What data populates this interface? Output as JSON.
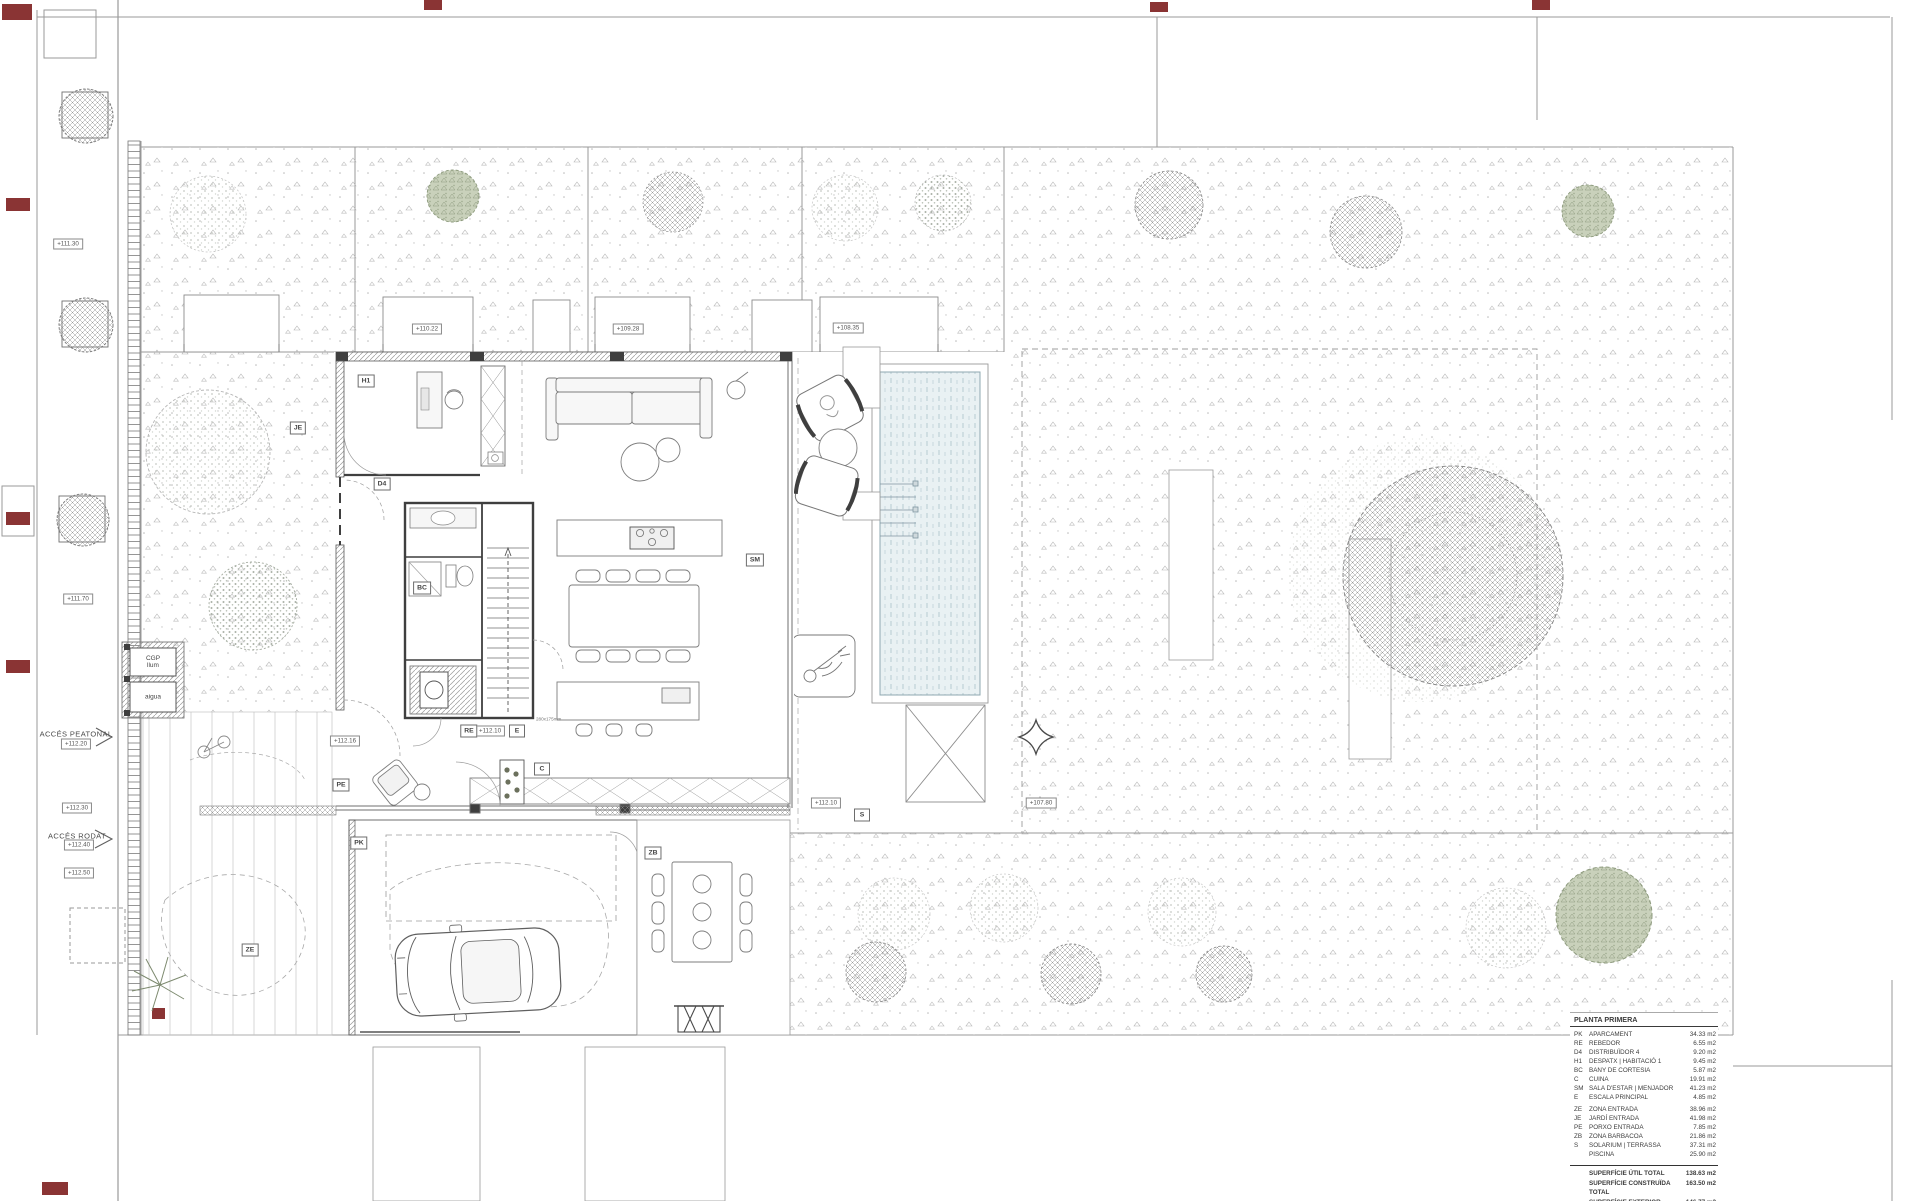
{
  "legend": {
    "header": "PLANTA PRIMERA",
    "groups": [
      {
        "rows": [
          {
            "code": "PK",
            "name": "APARCAMENT",
            "area": "34.33 m2"
          },
          {
            "code": "RE",
            "name": "REBEDOR",
            "area": "6.55 m2"
          },
          {
            "code": "D4",
            "name": "DISTRIBUÏDOR 4",
            "area": "9.20 m2"
          },
          {
            "code": "H1",
            "name": "DESPATX | HABITACIÓ 1",
            "area": "9.45 m2"
          },
          {
            "code": "BC",
            "name": "BANY DE CORTESIA",
            "area": "5.87 m2"
          },
          {
            "code": "C",
            "name": "CUINA",
            "area": "19.91 m2"
          },
          {
            "code": "SM",
            "name": "SALA D'ESTAR | MENJADOR",
            "area": "41.23 m2"
          },
          {
            "code": "E",
            "name": "ESCALA PRINCIPAL",
            "area": "4.85 m2"
          }
        ]
      },
      {
        "rows": [
          {
            "code": "ZE",
            "name": "ZONA ENTRADA",
            "area": "38.96 m2"
          },
          {
            "code": "JE",
            "name": "JARDÍ ENTRADA",
            "area": "41.98 m2"
          },
          {
            "code": "PE",
            "name": "PORXO ENTRADA",
            "area": "7.85 m2"
          },
          {
            "code": "ZB",
            "name": "ZONA BARBACOA",
            "area": "21.86 m2"
          },
          {
            "code": "S",
            "name": "SOLARIUM | TERRASSA",
            "area": "37.31 m2"
          },
          {
            "code": "",
            "name": "PISCINA",
            "area": "25.90 m2"
          }
        ]
      }
    ],
    "totals": [
      {
        "name": "SUPERFÍCIE ÚTIL TOTAL",
        "area": "138.63 m2"
      },
      {
        "name": "SUPERFÍCIE CONSTRUÏDA TOTAL",
        "area": "163.50 m2"
      },
      {
        "name": "SUPERFÍCIE EXTERIOR TOTAL",
        "area": "146.77 m2"
      }
    ]
  },
  "access": {
    "pedestrian": "ACCÉS PEATONAL",
    "road": "ACCÉS RODAT"
  },
  "utilities": {
    "cgp_line1": "CGP",
    "cgp_line2": "llum",
    "water": "aigua"
  },
  "stair_note": "280x175mm",
  "plan": {
    "elevation_tags": [
      {
        "text": "+111.30",
        "x": 68,
        "y": 244
      },
      {
        "text": "+111.70",
        "x": 78,
        "y": 599
      },
      {
        "text": "+112.20",
        "x": 76,
        "y": 744
      },
      {
        "text": "+112.30",
        "x": 77,
        "y": 808
      },
      {
        "text": "+112.40",
        "x": 79,
        "y": 845
      },
      {
        "text": "+112.50",
        "x": 79,
        "y": 873
      },
      {
        "text": "+110.22",
        "x": 427,
        "y": 329
      },
      {
        "text": "+109.28",
        "x": 628,
        "y": 329
      },
      {
        "text": "+108.35",
        "x": 848,
        "y": 328
      },
      {
        "text": "+112.16",
        "x": 345,
        "y": 741
      },
      {
        "text": "+112.10",
        "x": 490,
        "y": 731
      },
      {
        "text": "+112.10",
        "x": 826,
        "y": 803
      },
      {
        "text": "+107.80",
        "x": 1041,
        "y": 803
      }
    ],
    "room_tags": [
      {
        "code": "H1",
        "x": 366,
        "y": 381
      },
      {
        "code": "D4",
        "x": 382,
        "y": 484
      },
      {
        "code": "BC",
        "x": 422,
        "y": 588
      },
      {
        "code": "RE",
        "x": 469,
        "y": 731
      },
      {
        "code": "E",
        "x": 517,
        "y": 731
      },
      {
        "code": "C",
        "x": 542,
        "y": 769
      },
      {
        "code": "SM",
        "x": 755,
        "y": 560
      },
      {
        "code": "PE",
        "x": 341,
        "y": 785
      },
      {
        "code": "PK",
        "x": 359,
        "y": 843
      },
      {
        "code": "ZB",
        "x": 653,
        "y": 853
      },
      {
        "code": "S",
        "x": 862,
        "y": 815
      },
      {
        "code": "ZE",
        "x": 250,
        "y": 950
      },
      {
        "code": "JE",
        "x": 298,
        "y": 428
      }
    ],
    "colors": {
      "linework": "#8f8f8f",
      "walls": "#3f3f3f",
      "pool_fill": "#e9f1f3",
      "pool_stripe": "#a9c2ca",
      "section_mark": "#8a3434",
      "green_tree": "#a9b596"
    }
  }
}
